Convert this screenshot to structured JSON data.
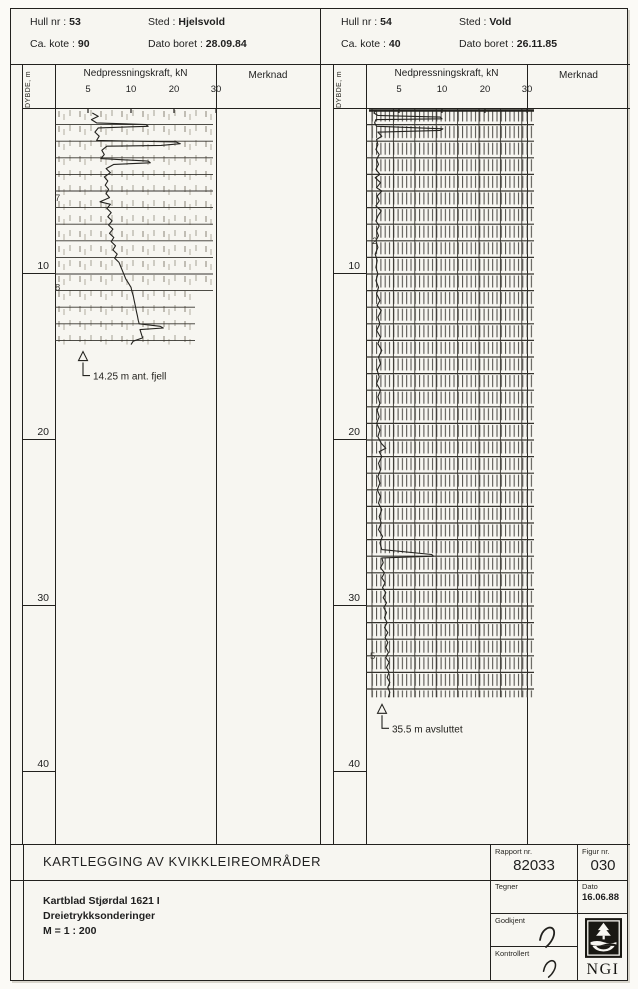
{
  "colors": {
    "ink": "#22211e",
    "paper": "#f7f6f1",
    "hatch_light": "#b3afa4",
    "hatch_dark": "#4a4843"
  },
  "panels": [
    {
      "header": {
        "hull_label": "Hull nr :",
        "hull_value": "53",
        "sted_label": "Sted :",
        "sted_value": "Hjelsvold",
        "kote_label": "Ca. kote :",
        "kote_value": "90",
        "dato_label": "Dato boret :",
        "dato_value": "28.09.84"
      },
      "axis": {
        "depth_label": "DYBDE, m",
        "force_label": "Nedpressningskraft, kN",
        "merknad_label": "Merknad",
        "value_ticks": [
          5,
          10,
          20,
          30
        ],
        "depth_ticks": [
          10,
          20,
          30,
          40
        ]
      },
      "chart_data": {
        "type": "line",
        "xlabel": "Nedpressningskraft, kN",
        "ylabel": "DYBDE, m",
        "x_ticks": [
          5,
          10,
          20,
          30
        ],
        "depth_range": [
          0,
          44
        ],
        "end_depth": 14.25,
        "end_annotation": "14.25 m ant. fjell",
        "texture": "light",
        "ann_x_px": 28,
        "strip": [
          {
            "from": 0,
            "to": 11.0,
            "x0": 0,
            "w": 158
          },
          {
            "from": 11.0,
            "to": 14.25,
            "x0": 0,
            "w": 140
          }
        ],
        "hand_notes": [
          {
            "depth": 5.6,
            "text": "7",
            "x": 0
          },
          {
            "depth": 11.0,
            "text": "8",
            "x": 0
          }
        ],
        "points": [
          [
            0.3,
            5.5
          ],
          [
            0.5,
            6.2
          ],
          [
            0.7,
            5.4
          ],
          [
            0.9,
            6.0
          ],
          [
            1.0,
            13.5
          ],
          [
            1.1,
            14.0
          ],
          [
            1.2,
            6.2
          ],
          [
            1.45,
            5.8
          ],
          [
            1.7,
            6.3
          ],
          [
            1.95,
            6.0
          ],
          [
            2.05,
            20.5
          ],
          [
            2.15,
            21.5
          ],
          [
            2.25,
            17.0
          ],
          [
            2.3,
            7.2
          ],
          [
            2.55,
            6.6
          ],
          [
            2.8,
            6.9
          ],
          [
            3.05,
            6.5
          ],
          [
            3.2,
            14.0
          ],
          [
            3.3,
            14.5
          ],
          [
            3.4,
            8.0
          ],
          [
            3.65,
            7.1
          ],
          [
            3.9,
            7.6
          ],
          [
            4.15,
            6.9
          ],
          [
            4.4,
            7.3
          ],
          [
            4.65,
            7.0
          ],
          [
            4.9,
            7.4
          ],
          [
            5.15,
            7.1
          ],
          [
            5.4,
            7.5
          ],
          [
            5.65,
            6.4
          ],
          [
            5.8,
            7.6
          ],
          [
            6.05,
            7.2
          ],
          [
            6.3,
            7.7
          ],
          [
            6.55,
            7.3
          ],
          [
            6.8,
            7.8
          ],
          [
            7.05,
            7.4
          ],
          [
            7.3,
            7.9
          ],
          [
            7.55,
            7.5
          ],
          [
            7.8,
            8.0
          ],
          [
            8.05,
            7.7
          ],
          [
            8.3,
            8.2
          ],
          [
            8.55,
            7.9
          ],
          [
            8.8,
            8.4
          ],
          [
            9.05,
            8.1
          ],
          [
            9.3,
            8.6
          ],
          [
            9.55,
            8.8
          ],
          [
            9.8,
            9.0
          ],
          [
            10.05,
            9.2
          ],
          [
            10.3,
            9.4
          ],
          [
            10.55,
            9.7
          ],
          [
            10.8,
            10.0
          ],
          [
            11.05,
            10.2
          ],
          [
            11.3,
            10.5
          ],
          [
            11.55,
            10.7
          ],
          [
            11.8,
            10.9
          ],
          [
            12.05,
            11.1
          ],
          [
            12.3,
            11.3
          ],
          [
            12.55,
            11.5
          ],
          [
            12.8,
            11.7
          ],
          [
            13.0,
            11.9
          ],
          [
            13.15,
            16.8
          ],
          [
            13.25,
            17.5
          ],
          [
            13.35,
            12.1
          ],
          [
            13.6,
            12.4
          ],
          [
            13.85,
            12.7
          ],
          [
            14.05,
            10.5
          ],
          [
            14.25,
            10.0
          ]
        ]
      }
    },
    {
      "header": {
        "hull_label": "Hull nr :",
        "hull_value": "54",
        "sted_label": "Sted :",
        "sted_value": "Vold",
        "kote_label": "Ca. kote :",
        "kote_value": "40",
        "dato_label": "Dato boret :",
        "dato_value": "26.11.85"
      },
      "axis": {
        "depth_label": "DYBDE, m",
        "force_label": "Nedpressningskraft, kN",
        "merknad_label": "Merknad",
        "value_ticks": [
          5,
          10,
          20,
          30
        ],
        "depth_ticks": [
          10,
          20,
          30,
          40
        ]
      },
      "chart_data": {
        "type": "line",
        "xlabel": "Nedpressningskraft, kN",
        "ylabel": "DYBDE, m",
        "x_ticks": [
          5,
          10,
          20,
          30
        ],
        "depth_range": [
          0,
          44
        ],
        "end_depth": 35.5,
        "end_annotation": "35.5 m avsluttet",
        "texture": "dense",
        "ann_x_px": 16,
        "strip": [
          {
            "from": 0,
            "to": 35.5,
            "x0": 4,
            "w": 164
          }
        ],
        "hand_notes": [
          {
            "depth": 8.2,
            "text": "2",
            "x": 6
          },
          {
            "depth": 33.2,
            "text": "5",
            "x": 4
          }
        ],
        "points": [
          [
            0.15,
            1.5
          ],
          [
            0.3,
            1.2
          ],
          [
            0.45,
            1.8
          ],
          [
            0.55,
            9.8
          ],
          [
            0.65,
            10.0
          ],
          [
            0.7,
            1.5
          ],
          [
            0.9,
            1.3
          ],
          [
            1.1,
            1.6
          ],
          [
            1.25,
            10.2
          ],
          [
            1.35,
            9.8
          ],
          [
            1.45,
            1.8
          ],
          [
            1.7,
            2.4
          ],
          [
            1.9,
            1.6
          ],
          [
            2.2,
            1.8
          ],
          [
            2.5,
            1.5
          ],
          [
            2.8,
            2.0
          ],
          [
            3.1,
            1.6
          ],
          [
            3.4,
            1.9
          ],
          [
            3.7,
            1.5
          ],
          [
            4.0,
            2.1
          ],
          [
            4.2,
            1.4
          ],
          [
            4.5,
            2.2
          ],
          [
            4.8,
            1.6
          ],
          [
            5.0,
            2.4
          ],
          [
            5.3,
            1.7
          ],
          [
            5.6,
            2.0
          ],
          [
            5.9,
            1.5
          ],
          [
            6.2,
            2.3
          ],
          [
            6.5,
            1.8
          ],
          [
            6.8,
            1.5
          ],
          [
            7.1,
            2.0
          ],
          [
            7.4,
            1.6
          ],
          [
            7.7,
            1.9
          ],
          [
            8.0,
            1.5
          ],
          [
            8.4,
            1.8
          ],
          [
            8.8,
            1.4
          ],
          [
            9.2,
            1.7
          ],
          [
            9.6,
            1.5
          ],
          [
            10.0,
            1.8
          ],
          [
            10.4,
            1.5
          ],
          [
            10.8,
            1.9
          ],
          [
            11.2,
            1.6
          ],
          [
            11.6,
            2.1
          ],
          [
            11.9,
            1.7
          ],
          [
            12.2,
            2.3
          ],
          [
            12.6,
            1.8
          ],
          [
            13.0,
            2.1
          ],
          [
            13.4,
            1.6
          ],
          [
            13.8,
            2.2
          ],
          [
            14.2,
            1.8
          ],
          [
            14.6,
            2.4
          ],
          [
            15.0,
            1.9
          ],
          [
            15.4,
            2.2
          ],
          [
            15.8,
            1.7
          ],
          [
            16.2,
            2.0
          ],
          [
            16.6,
            1.6
          ],
          [
            17.0,
            2.2
          ],
          [
            17.4,
            1.8
          ],
          [
            17.8,
            2.1
          ],
          [
            18.2,
            1.7
          ],
          [
            18.6,
            2.0
          ],
          [
            19.0,
            1.6
          ],
          [
            19.4,
            2.1
          ],
          [
            19.8,
            1.8
          ],
          [
            20.2,
            2.3
          ],
          [
            20.5,
            3.0
          ],
          [
            20.7,
            2.0
          ],
          [
            21.0,
            2.4
          ],
          [
            21.4,
            1.9
          ],
          [
            21.8,
            2.2
          ],
          [
            22.2,
            1.8
          ],
          [
            22.6,
            2.1
          ],
          [
            23.0,
            1.7
          ],
          [
            23.4,
            2.2
          ],
          [
            23.8,
            1.9
          ],
          [
            24.2,
            2.4
          ],
          [
            24.6,
            2.0
          ],
          [
            25.0,
            2.3
          ],
          [
            25.4,
            1.9
          ],
          [
            25.8,
            2.5
          ],
          [
            26.2,
            2.1
          ],
          [
            26.6,
            2.4
          ],
          [
            26.9,
            8.8
          ],
          [
            27.0,
            9.0
          ],
          [
            27.1,
            2.4
          ],
          [
            27.4,
            2.6
          ],
          [
            27.7,
            2.2
          ],
          [
            28.0,
            2.8
          ],
          [
            28.3,
            2.4
          ],
          [
            28.6,
            2.9
          ],
          [
            28.9,
            2.5
          ],
          [
            29.2,
            3.0
          ],
          [
            29.5,
            2.6
          ],
          [
            29.8,
            3.1
          ],
          [
            30.1,
            2.7
          ],
          [
            30.4,
            3.1
          ],
          [
            30.7,
            2.8
          ],
          [
            31.0,
            3.2
          ],
          [
            31.3,
            2.8
          ],
          [
            31.6,
            3.3
          ],
          [
            31.9,
            2.9
          ],
          [
            32.2,
            3.3
          ],
          [
            32.5,
            3.0
          ],
          [
            32.8,
            3.4
          ],
          [
            33.1,
            3.0
          ],
          [
            33.4,
            3.5
          ],
          [
            33.7,
            3.1
          ],
          [
            34.0,
            3.5
          ],
          [
            34.3,
            3.2
          ],
          [
            34.6,
            3.6
          ],
          [
            34.9,
            3.3
          ],
          [
            35.2,
            3.6
          ],
          [
            35.5,
            3.4
          ]
        ]
      }
    }
  ],
  "footer": {
    "title": "KARTLEGGING AV KVIKKLEIREOMRÅDER",
    "line1": "Kartblad Stjørdal 1621 I",
    "line2": "Dreietrykksonderinger",
    "line3": "M = 1 : 200",
    "rapport_label": "Rapport nr.",
    "rapport_value": "82033",
    "figur_label": "Figur nr.",
    "figur_value": "030",
    "tegner_label": "Tegner",
    "dato_label": "Dato",
    "dato_value": "16.06.88",
    "godkjent_label": "Godkjent",
    "kontrollert_label": "Kontrollert",
    "logo_text": "NGI"
  }
}
